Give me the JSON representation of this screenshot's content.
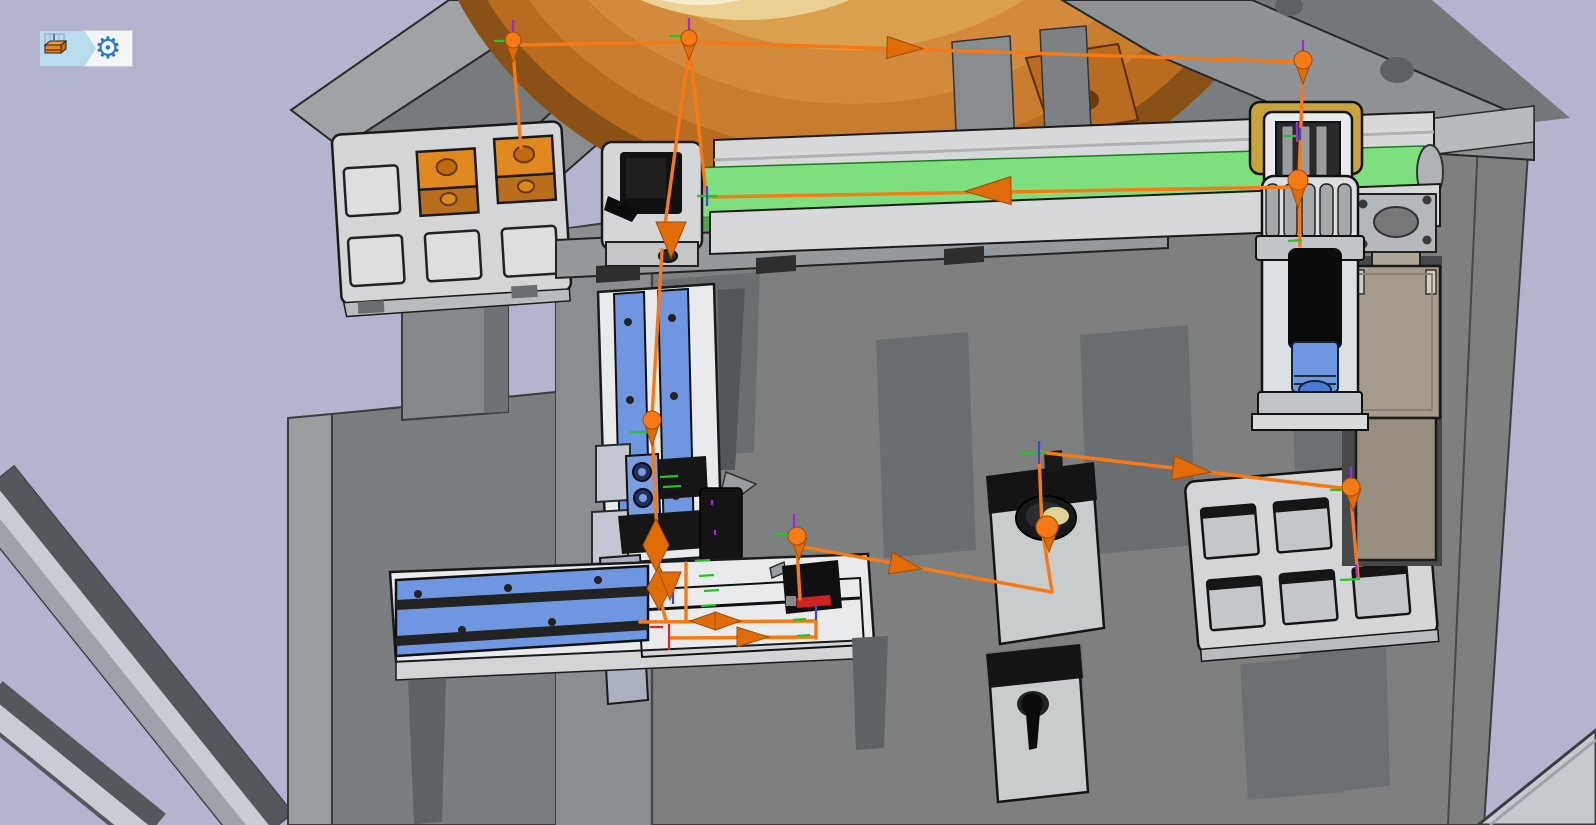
{
  "toolbar": {
    "buttons": [
      {
        "id": "model-view",
        "icon": "machine-3d-icon",
        "tooltip": "Assembly model"
      },
      {
        "id": "settings",
        "icon": "gear-icon",
        "tooltip": "Settings"
      }
    ]
  },
  "colors": {
    "bg": "#b3b5cf",
    "path": "#f57a15",
    "arrow": "#e06c07",
    "arrow_dark": "#a34c05",
    "tick_green": "#27c327",
    "tick_blue": "#2f48e8",
    "tick_purple": "#a428d8",
    "tick_red": "#e32222",
    "belt": "#7ddf7d",
    "belt_dark": "#4aa84a",
    "blue": "#6f96e0",
    "blue_dark": "#4d7ad0",
    "dome": "#c87c2e",
    "gold": "#c9a33c",
    "block_orange": "#e0891f",
    "block_orange_front": "#b96e1c",
    "toolbar_blue": "#b9dcec",
    "gear_blue": "#2878d0",
    "tray": "#d3d5d7",
    "plate": "#7d807f"
  },
  "trajectory": {
    "segments": [
      [
        513,
        45,
        688,
        42
      ],
      [
        688,
        42,
        1303,
        62
      ],
      [
        513,
        52,
        521,
        148
      ],
      [
        689,
        50,
        664,
        232
      ],
      [
        690,
        50,
        706,
        193
      ],
      [
        1303,
        68,
        1299,
        178
      ],
      [
        1299,
        190,
        1300,
        246
      ],
      [
        1297,
        187,
        708,
        197
      ],
      [
        662,
        250,
        652,
        416
      ],
      [
        652,
        428,
        660,
        598
      ],
      [
        660,
        598,
        666,
        621
      ],
      [
        640,
        622,
        816,
        621
      ],
      [
        671,
        638,
        816,
        637
      ],
      [
        816,
        621,
        816,
        638
      ],
      [
        686,
        563,
        686,
        621
      ],
      [
        797,
        548,
        800,
        599
      ],
      [
        798,
        546,
        1052,
        592
      ],
      [
        1052,
        592,
        1042,
        528
      ],
      [
        1042,
        528,
        1039,
        454
      ],
      [
        1039,
        452,
        1350,
        489
      ],
      [
        1351,
        497,
        1358,
        578
      ]
    ],
    "spheres": [
      [
        513,
        40,
        8
      ],
      [
        689,
        38,
        8
      ],
      [
        1303,
        60,
        9
      ],
      [
        652,
        420,
        9
      ],
      [
        1298,
        180,
        10
      ],
      [
        1047,
        527,
        11
      ],
      [
        797,
        536,
        9
      ],
      [
        1351,
        487,
        9
      ]
    ],
    "cones": [
      [
        513,
        62,
        15,
        20
      ],
      [
        689,
        60,
        15,
        20
      ],
      [
        1303,
        84,
        16,
        22
      ],
      [
        671,
        258,
        30,
        36
      ],
      [
        652,
        446,
        16,
        24
      ],
      [
        1298,
        208,
        18,
        26
      ],
      [
        1049,
        552,
        20,
        26
      ],
      [
        799,
        560,
        16,
        22
      ],
      [
        1353,
        511,
        16,
        22
      ],
      [
        670,
        600,
        22,
        28
      ]
    ],
    "diamonds": [
      [
        656,
        545,
        26,
        52
      ],
      [
        659,
        588,
        24,
        44
      ]
    ],
    "arrows": [
      [
        905,
        48,
        1.9,
        36,
        22
      ],
      [
        988,
        191,
        179,
        46,
        28
      ],
      [
        906,
        566,
        10.3,
        32,
        22
      ],
      [
        1192,
        470,
        6.8,
        38,
        24
      ],
      [
        703,
        621,
        180,
        26,
        18
      ],
      [
        728,
        621,
        0,
        26,
        18
      ],
      [
        753,
        637,
        0,
        32,
        20
      ]
    ],
    "ticks": [
      [
        494,
        41,
        511,
        41,
        "g"
      ],
      [
        513,
        20,
        513,
        34,
        "p"
      ],
      [
        670,
        36,
        687,
        36,
        "g"
      ],
      [
        689,
        18,
        689,
        32,
        "p"
      ],
      [
        1303,
        40,
        1303,
        55,
        "p"
      ],
      [
        630,
        432,
        648,
        432,
        "g"
      ],
      [
        774,
        534,
        792,
        534,
        "g"
      ],
      [
        794,
        514,
        794,
        528,
        "p"
      ],
      [
        1330,
        490,
        1346,
        490,
        "g"
      ],
      [
        1351,
        467,
        1351,
        481,
        "p"
      ],
      [
        1020,
        453,
        1046,
        453,
        "g"
      ],
      [
        1039,
        441,
        1039,
        464,
        "b"
      ],
      [
        697,
        196,
        717,
        196,
        "g"
      ],
      [
        707,
        186,
        707,
        206,
        "b"
      ],
      [
        1340,
        580,
        1360,
        579,
        "g"
      ],
      [
        1356,
        564,
        1357,
        577,
        "p"
      ],
      [
        1288,
        241,
        1302,
        240,
        "g"
      ],
      [
        660,
        477,
        678,
        476,
        "g"
      ],
      [
        663,
        487,
        681,
        486,
        "g"
      ],
      [
        695,
        561,
        710,
        560,
        "g"
      ],
      [
        699,
        576,
        714,
        575,
        "g"
      ],
      [
        704,
        591,
        719,
        590,
        "g"
      ],
      [
        701,
        606,
        716,
        605,
        "g"
      ],
      [
        793,
        620,
        806,
        619,
        "g"
      ],
      [
        797,
        636,
        810,
        635,
        "g"
      ],
      [
        816,
        606,
        816,
        620,
        "b"
      ],
      [
        673,
        592,
        673,
        604,
        "b"
      ],
      [
        669,
        624,
        669,
        650,
        "r"
      ],
      [
        650,
        627,
        663,
        627,
        "r"
      ],
      [
        712,
        500,
        712,
        505,
        "p"
      ],
      [
        715,
        530,
        715,
        535,
        "p"
      ],
      [
        1297,
        122,
        1297,
        142,
        "p"
      ],
      [
        1284,
        136,
        1296,
        136,
        "g"
      ],
      [
        1300,
        128,
        1300,
        140,
        "b"
      ]
    ]
  }
}
